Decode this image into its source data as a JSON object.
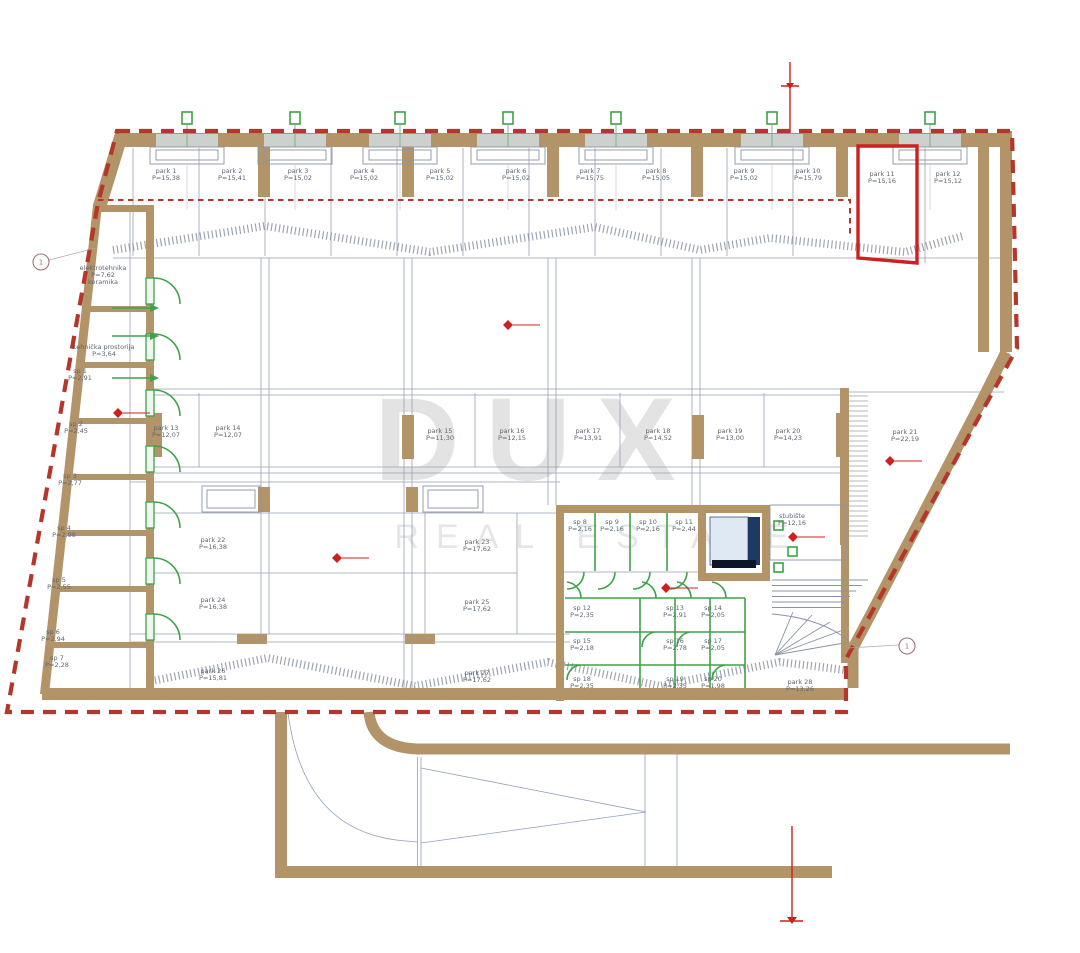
{
  "watermark": {
    "title": "DUX",
    "subtitle": "REAL ESTATE"
  },
  "colors": {
    "wall": "#b29468",
    "boundary_red": "#b5372c",
    "highlight_red": "#d01f1f",
    "green": "#3fa24a",
    "elevator_navy": "#1d3a63",
    "watermark_gray": "#e3e3e3",
    "label_gray": "#5f6673",
    "line_gray": "#99a1b1"
  },
  "windows": {
    "x": [
      187,
      295,
      400,
      508,
      616,
      772,
      930
    ]
  },
  "grid_bubbles": [
    {
      "x": 41,
      "y": 262,
      "label": "1",
      "lx": 96,
      "ly": 248
    },
    {
      "x": 907,
      "y": 646,
      "label": "1",
      "lx": 848,
      "ly": 648
    }
  ],
  "level_markers": [
    {
      "x": 118,
      "y": 413
    },
    {
      "x": 508,
      "y": 325
    },
    {
      "x": 337,
      "y": 558
    },
    {
      "x": 890,
      "y": 461
    },
    {
      "x": 666,
      "y": 588
    },
    {
      "x": 793,
      "y": 537
    }
  ],
  "labels": {
    "rooms": [
      {
        "x": 166,
        "y": 173,
        "lines": [
          "park 1",
          "P=15,38"
        ]
      },
      {
        "x": 232,
        "y": 173,
        "lines": [
          "park 2",
          "P=15,41"
        ]
      },
      {
        "x": 298,
        "y": 173,
        "lines": [
          "park 3",
          "P=15,02"
        ]
      },
      {
        "x": 364,
        "y": 173,
        "lines": [
          "park 4",
          "P=15,02"
        ]
      },
      {
        "x": 440,
        "y": 173,
        "lines": [
          "park 5",
          "P=15,02"
        ]
      },
      {
        "x": 516,
        "y": 173,
        "lines": [
          "park 6",
          "P=15,02"
        ]
      },
      {
        "x": 590,
        "y": 173,
        "lines": [
          "park 7",
          "P=15,75"
        ]
      },
      {
        "x": 656,
        "y": 173,
        "lines": [
          "park 8",
          "P=15,05"
        ]
      },
      {
        "x": 744,
        "y": 173,
        "lines": [
          "park 9",
          "P=15,02"
        ]
      },
      {
        "x": 808,
        "y": 173,
        "lines": [
          "park 10",
          "P=15,79"
        ]
      },
      {
        "x": 882,
        "y": 176,
        "lines": [
          "park 11",
          "P=15,16"
        ]
      },
      {
        "x": 948,
        "y": 176,
        "lines": [
          "park 12",
          "P=15,12"
        ]
      },
      {
        "x": 166,
        "y": 430,
        "lines": [
          "park 13",
          "P=12,07"
        ]
      },
      {
        "x": 228,
        "y": 430,
        "lines": [
          "park 14",
          "P=12,07"
        ]
      },
      {
        "x": 440,
        "y": 433,
        "lines": [
          "park 15",
          "P=11,30"
        ]
      },
      {
        "x": 512,
        "y": 433,
        "lines": [
          "park 16",
          "P=12,15"
        ]
      },
      {
        "x": 588,
        "y": 433,
        "lines": [
          "park 17",
          "P=13,91"
        ]
      },
      {
        "x": 658,
        "y": 433,
        "lines": [
          "park 18",
          "P=14,52"
        ]
      },
      {
        "x": 730,
        "y": 433,
        "lines": [
          "park 19",
          "P=13,00"
        ]
      },
      {
        "x": 788,
        "y": 433,
        "lines": [
          "park 20",
          "P=14,23"
        ]
      },
      {
        "x": 905,
        "y": 434,
        "lines": [
          "park 21",
          "P=22,19"
        ]
      },
      {
        "x": 213,
        "y": 542,
        "lines": [
          "park 22",
          "P=16,38"
        ]
      },
      {
        "x": 477,
        "y": 544,
        "lines": [
          "park 23",
          "P=17,62"
        ]
      },
      {
        "x": 213,
        "y": 602,
        "lines": [
          "park 24",
          "P=16,38"
        ]
      },
      {
        "x": 477,
        "y": 604,
        "lines": [
          "park 25",
          "P=17,62"
        ]
      },
      {
        "x": 213,
        "y": 673,
        "lines": [
          "park 26",
          "P=15,81"
        ]
      },
      {
        "x": 477,
        "y": 675,
        "lines": [
          "park 27",
          "P=17,62"
        ]
      },
      {
        "x": 800,
        "y": 684,
        "lines": [
          "park 28",
          "P=13,26"
        ]
      },
      {
        "x": 103,
        "y": 270,
        "lines": [
          "elektrotehnika",
          "P=7,62",
          "keramika"
        ]
      },
      {
        "x": 104,
        "y": 349,
        "lines": [
          "tehnička prostorija",
          "P=3,64"
        ]
      },
      {
        "x": 80,
        "y": 373,
        "lines": [
          "sp 1",
          "P=2,91"
        ]
      },
      {
        "x": 76,
        "y": 426,
        "lines": [
          "sp 2",
          "P=2,45"
        ]
      },
      {
        "x": 70,
        "y": 478,
        "lines": [
          "sp 3",
          "P=2,77"
        ]
      },
      {
        "x": 64,
        "y": 530,
        "lines": [
          "sp 4",
          "P=2,98"
        ]
      },
      {
        "x": 59,
        "y": 582,
        "lines": [
          "sp 5",
          "P=2,55"
        ]
      },
      {
        "x": 53,
        "y": 634,
        "lines": [
          "sp 6",
          "P=2,94"
        ]
      },
      {
        "x": 57,
        "y": 660,
        "lines": [
          "sp 7",
          "P=2,28"
        ]
      },
      {
        "x": 580,
        "y": 524,
        "lines": [
          "sp 8",
          "P=2,16"
        ]
      },
      {
        "x": 612,
        "y": 524,
        "lines": [
          "sp 9",
          "P=2,16"
        ]
      },
      {
        "x": 648,
        "y": 524,
        "lines": [
          "sp 10",
          "P=2,16"
        ]
      },
      {
        "x": 684,
        "y": 524,
        "lines": [
          "sp 11",
          "P=2,44"
        ]
      },
      {
        "x": 582,
        "y": 610,
        "lines": [
          "sp 12",
          "P=2,35"
        ]
      },
      {
        "x": 675,
        "y": 610,
        "lines": [
          "sp 13",
          "P=2,91"
        ]
      },
      {
        "x": 713,
        "y": 610,
        "lines": [
          "sp 14",
          "P=2,05"
        ]
      },
      {
        "x": 582,
        "y": 643,
        "lines": [
          "sp 15",
          "P=2,18"
        ]
      },
      {
        "x": 675,
        "y": 643,
        "lines": [
          "sp 16",
          "P=2,78"
        ]
      },
      {
        "x": 713,
        "y": 643,
        "lines": [
          "sp 17",
          "P=2,05"
        ]
      },
      {
        "x": 582,
        "y": 681,
        "lines": [
          "sp 18",
          "P=2,35"
        ]
      },
      {
        "x": 675,
        "y": 681,
        "lines": [
          "sp 19",
          "P=2,35"
        ]
      },
      {
        "x": 713,
        "y": 681,
        "lines": [
          "sp 20",
          "P=1,98"
        ]
      },
      {
        "x": 792,
        "y": 518,
        "lines": [
          "stubište",
          "P=12,16"
        ]
      }
    ]
  }
}
